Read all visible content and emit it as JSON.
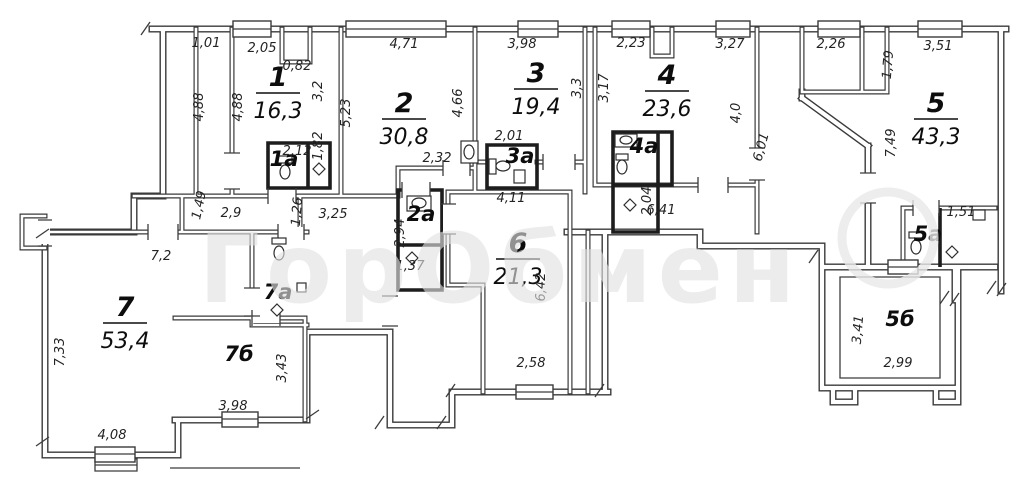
{
  "watermark": {
    "text": "ГорОбмен"
  },
  "drawing": {
    "line_color": "#3a3a3a",
    "background": "#ffffff",
    "watermark_color": "#e2e2e2"
  },
  "rooms": [
    {
      "id": "room-1",
      "number": "1",
      "area": "16,3",
      "x": 278,
      "y": 86
    },
    {
      "id": "room-2",
      "number": "2",
      "area": "30,8",
      "x": 404,
      "y": 112
    },
    {
      "id": "room-3",
      "number": "3",
      "area": "19,4",
      "x": 536,
      "y": 82
    },
    {
      "id": "room-4",
      "number": "4",
      "area": "23,6",
      "x": 667,
      "y": 84
    },
    {
      "id": "room-5",
      "number": "5",
      "area": "43,3",
      "x": 936,
      "y": 112
    },
    {
      "id": "room-6",
      "number": "6",
      "area": "21,3",
      "x": 518,
      "y": 252
    },
    {
      "id": "room-7",
      "number": "7",
      "area": "53,4",
      "x": 125,
      "y": 316
    }
  ],
  "sub_rooms": [
    {
      "id": "room-1a",
      "label": "1а",
      "x": 284,
      "y": 166
    },
    {
      "id": "room-2a",
      "label": "2а",
      "x": 421,
      "y": 221
    },
    {
      "id": "room-3a",
      "label": "3а",
      "x": 520,
      "y": 163
    },
    {
      "id": "room-4a",
      "label": "4а",
      "x": 644,
      "y": 153
    },
    {
      "id": "room-5a",
      "label": "5а",
      "x": 928,
      "y": 241
    },
    {
      "id": "room-5b",
      "label": "5б",
      "x": 900,
      "y": 326
    },
    {
      "id": "room-7a",
      "label": "7а",
      "x": 278,
      "y": 299
    },
    {
      "id": "room-7b",
      "label": "7б",
      "x": 239,
      "y": 361
    }
  ],
  "dimensions": [
    {
      "t": "1,01",
      "x": 206,
      "y": 47,
      "r": 0
    },
    {
      "t": "2,05",
      "x": 262,
      "y": 52,
      "r": 0
    },
    {
      "t": "0,82",
      "x": 297,
      "y": 70,
      "r": 0
    },
    {
      "t": "4,71",
      "x": 404,
      "y": 48,
      "r": 0
    },
    {
      "t": "3,98",
      "x": 522,
      "y": 48,
      "r": 0
    },
    {
      "t": "2,23",
      "x": 631,
      "y": 47,
      "r": 0
    },
    {
      "t": "3,27",
      "x": 730,
      "y": 48,
      "r": 0
    },
    {
      "t": "2,26",
      "x": 831,
      "y": 48,
      "r": 0
    },
    {
      "t": "3,51",
      "x": 938,
      "y": 50,
      "r": 0
    },
    {
      "t": "4,88",
      "x": 203,
      "y": 107,
      "r": -90
    },
    {
      "t": "4,88",
      "x": 242,
      "y": 107,
      "r": -90
    },
    {
      "t": "3,2",
      "x": 322,
      "y": 91,
      "r": -90
    },
    {
      "t": "5,23",
      "x": 350,
      "y": 113,
      "r": -90
    },
    {
      "t": "4,66",
      "x": 462,
      "y": 103,
      "r": -90
    },
    {
      "t": "3,3",
      "x": 581,
      "y": 88,
      "r": -90
    },
    {
      "t": "3,17",
      "x": 608,
      "y": 88,
      "r": -90
    },
    {
      "t": "4,0",
      "x": 740,
      "y": 113,
      "r": -90
    },
    {
      "t": "1,79",
      "x": 892,
      "y": 65,
      "r": -85
    },
    {
      "t": "7,49",
      "x": 895,
      "y": 143,
      "r": -90
    },
    {
      "t": "6,01",
      "x": 765,
      "y": 148,
      "r": -75
    },
    {
      "t": "2,12",
      "x": 297,
      "y": 155,
      "r": 0
    },
    {
      "t": "1,82",
      "x": 322,
      "y": 146,
      "r": -90
    },
    {
      "t": "2,32",
      "x": 437,
      "y": 162,
      "r": 0
    },
    {
      "t": "2,01",
      "x": 509,
      "y": 140,
      "r": 0
    },
    {
      "t": "2,04",
      "x": 651,
      "y": 201,
      "r": -90
    },
    {
      "t": "1,51",
      "x": 961,
      "y": 216,
      "r": 0
    },
    {
      "t": "1,49",
      "x": 203,
      "y": 206,
      "r": -78
    },
    {
      "t": "2,9",
      "x": 231,
      "y": 217,
      "r": 0
    },
    {
      "t": "1,26",
      "x": 301,
      "y": 212,
      "r": -85
    },
    {
      "t": "3,25",
      "x": 333,
      "y": 218,
      "r": 0
    },
    {
      "t": "6,41",
      "x": 661,
      "y": 214,
      "r": 0
    },
    {
      "t": "4,11",
      "x": 511,
      "y": 202,
      "r": 0
    },
    {
      "t": "2,94",
      "x": 404,
      "y": 233,
      "r": -90
    },
    {
      "t": "1,37",
      "x": 410,
      "y": 270,
      "r": 0
    },
    {
      "t": "6,42",
      "x": 545,
      "y": 287,
      "r": -90
    },
    {
      "t": "2,58",
      "x": 531,
      "y": 367,
      "r": 0
    },
    {
      "t": "7,2",
      "x": 161,
      "y": 260,
      "r": 0
    },
    {
      "t": "7,33",
      "x": 64,
      "y": 352,
      "r": -90
    },
    {
      "t": "4,08",
      "x": 112,
      "y": 439,
      "r": 0
    },
    {
      "t": "3,98",
      "x": 233,
      "y": 410,
      "r": 0
    },
    {
      "t": "3,43",
      "x": 286,
      "y": 368,
      "r": -90
    },
    {
      "t": "3,41",
      "x": 862,
      "y": 330,
      "r": -85
    },
    {
      "t": "2,99",
      "x": 898,
      "y": 367,
      "r": 0
    }
  ]
}
